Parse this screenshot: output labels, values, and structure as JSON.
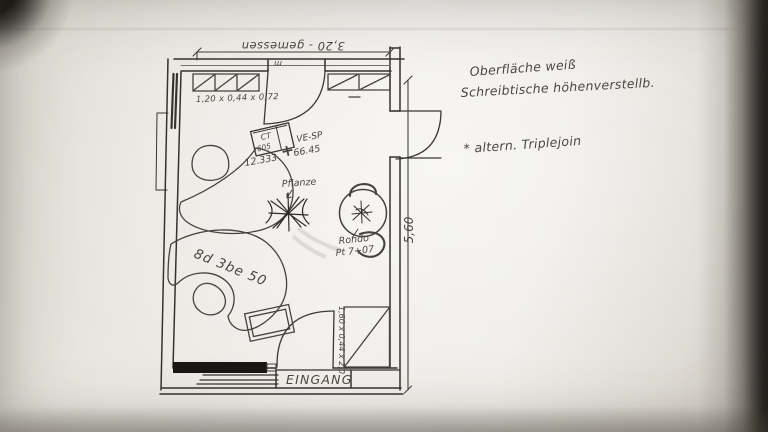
{
  "plan": {
    "dimensions": {
      "top": "3,20 - gemessen",
      "top_unit": "m",
      "right": "5,60",
      "sideboard": "1,20 x 0,44 x 0,72",
      "cabinet": "1,60 x 0,44 x 2,0"
    },
    "labels": {
      "ct_line1": "CT",
      "ct_line2": "605",
      "ct_plus": "+",
      "ct_ve": "VE-SP",
      "ct_num1": "66.45",
      "ct_num2": "12.333",
      "plant": "Pflanze",
      "desk_code": "8d 3be 50",
      "table_name": "Rondo",
      "table_code": "Pt 7+07",
      "entrance": "EINGANG"
    },
    "notes": {
      "line1": "Oberfläche weiß",
      "line2": "Schreibtische höhenverstellb.",
      "line3": "* altern. Triplejoin"
    },
    "colors": {
      "pencil": "#45423e",
      "ink": "#2c2a27",
      "paper": "#edebe6"
    }
  }
}
